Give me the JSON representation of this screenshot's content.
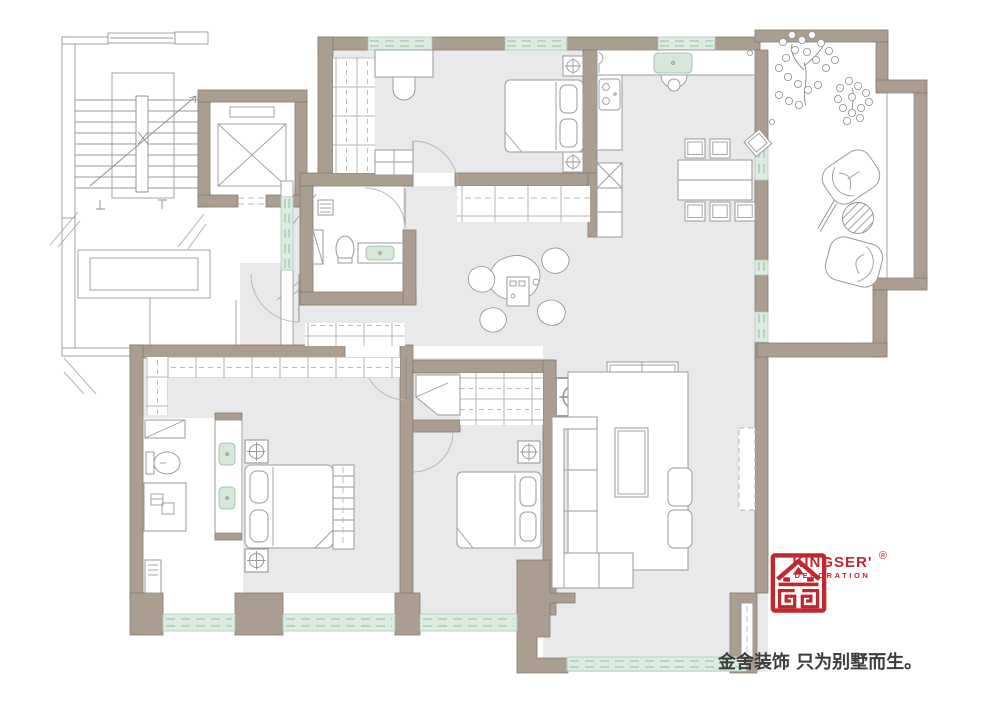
{
  "page": {
    "width": 1000,
    "height": 707,
    "bg": "#ffffff",
    "type": "residential-floor-plan"
  },
  "colors": {
    "page_bg": "#ffffff",
    "wall": "#ab9e90",
    "wall_stroke": "#867b6d",
    "floor": "#e9e9eb",
    "window_fill": "#ddece3",
    "window_line": "#a3c7ae",
    "fixture_green": "#d5e8da",
    "logo_red": "#c2262e",
    "text_dark": "#3d3d3d"
  },
  "branding": {
    "logo_mark": "kingser-gold-seal-logo",
    "registered": "®",
    "brand": "KINGSER'",
    "division": "DECORATION",
    "tagline": "金舍装饰 只为别墅而生。"
  },
  "legend": {
    "icon_names": [
      "stairwell",
      "stair-direction-arrow",
      "elevator",
      "opening-break-mark",
      "entry-door-arc",
      "window-hatch",
      "wardrobe-cabinet",
      "double-bed",
      "pillow",
      "nightstand-lamp-table",
      "desk",
      "desk-chair",
      "bench",
      "bathroom-shelf",
      "toilet",
      "wash-basin",
      "shower-tray",
      "kitchen-sink",
      "gas-stove",
      "refrigerator",
      "tall-cabinet",
      "dining-table",
      "dining-chair",
      "floor-cushions",
      "tea-table",
      "media-cabinet",
      "sofa",
      "coffee-table",
      "armchair",
      "tv-cabinet",
      "rug",
      "vanity-double-basin",
      "laundry-cabinet",
      "balcony-tree",
      "lounge-chair",
      "patio-round-table",
      "column-lamp-table"
    ]
  }
}
